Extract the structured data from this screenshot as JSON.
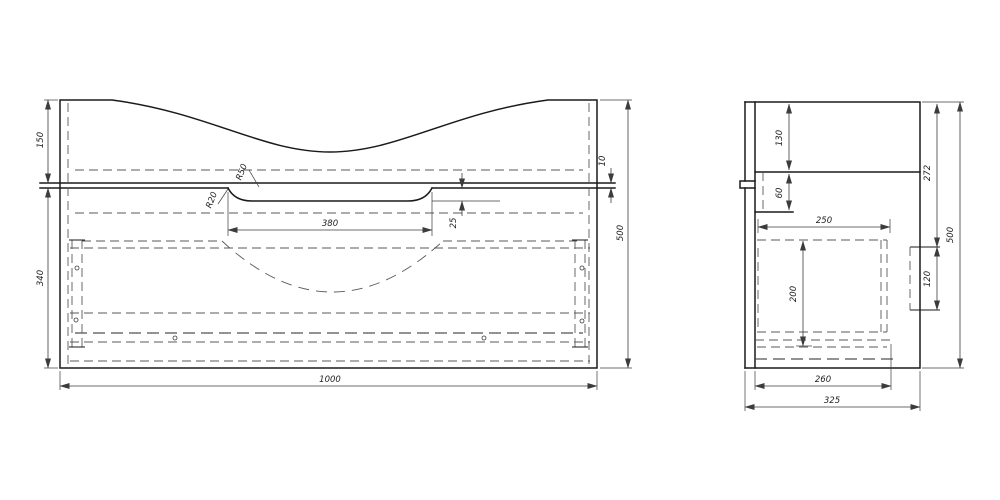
{
  "front_view": {
    "overall_width": "1000",
    "overall_height": "500",
    "upper_section_height": "150",
    "lower_section_height": "340",
    "countertop_thickness": "10",
    "notch_width": "380",
    "notch_depth": "25",
    "radius_small": "R20",
    "radius_large": "R50"
  },
  "side_view": {
    "overall_height": "500",
    "overall_depth": "325",
    "bottom_panel_depth": "260",
    "drawer_depth": "250",
    "drawer_height": "200",
    "backsplash_height": "130",
    "top_gap": "60",
    "upper_back_height": "272",
    "mount_rail_height": "120"
  }
}
